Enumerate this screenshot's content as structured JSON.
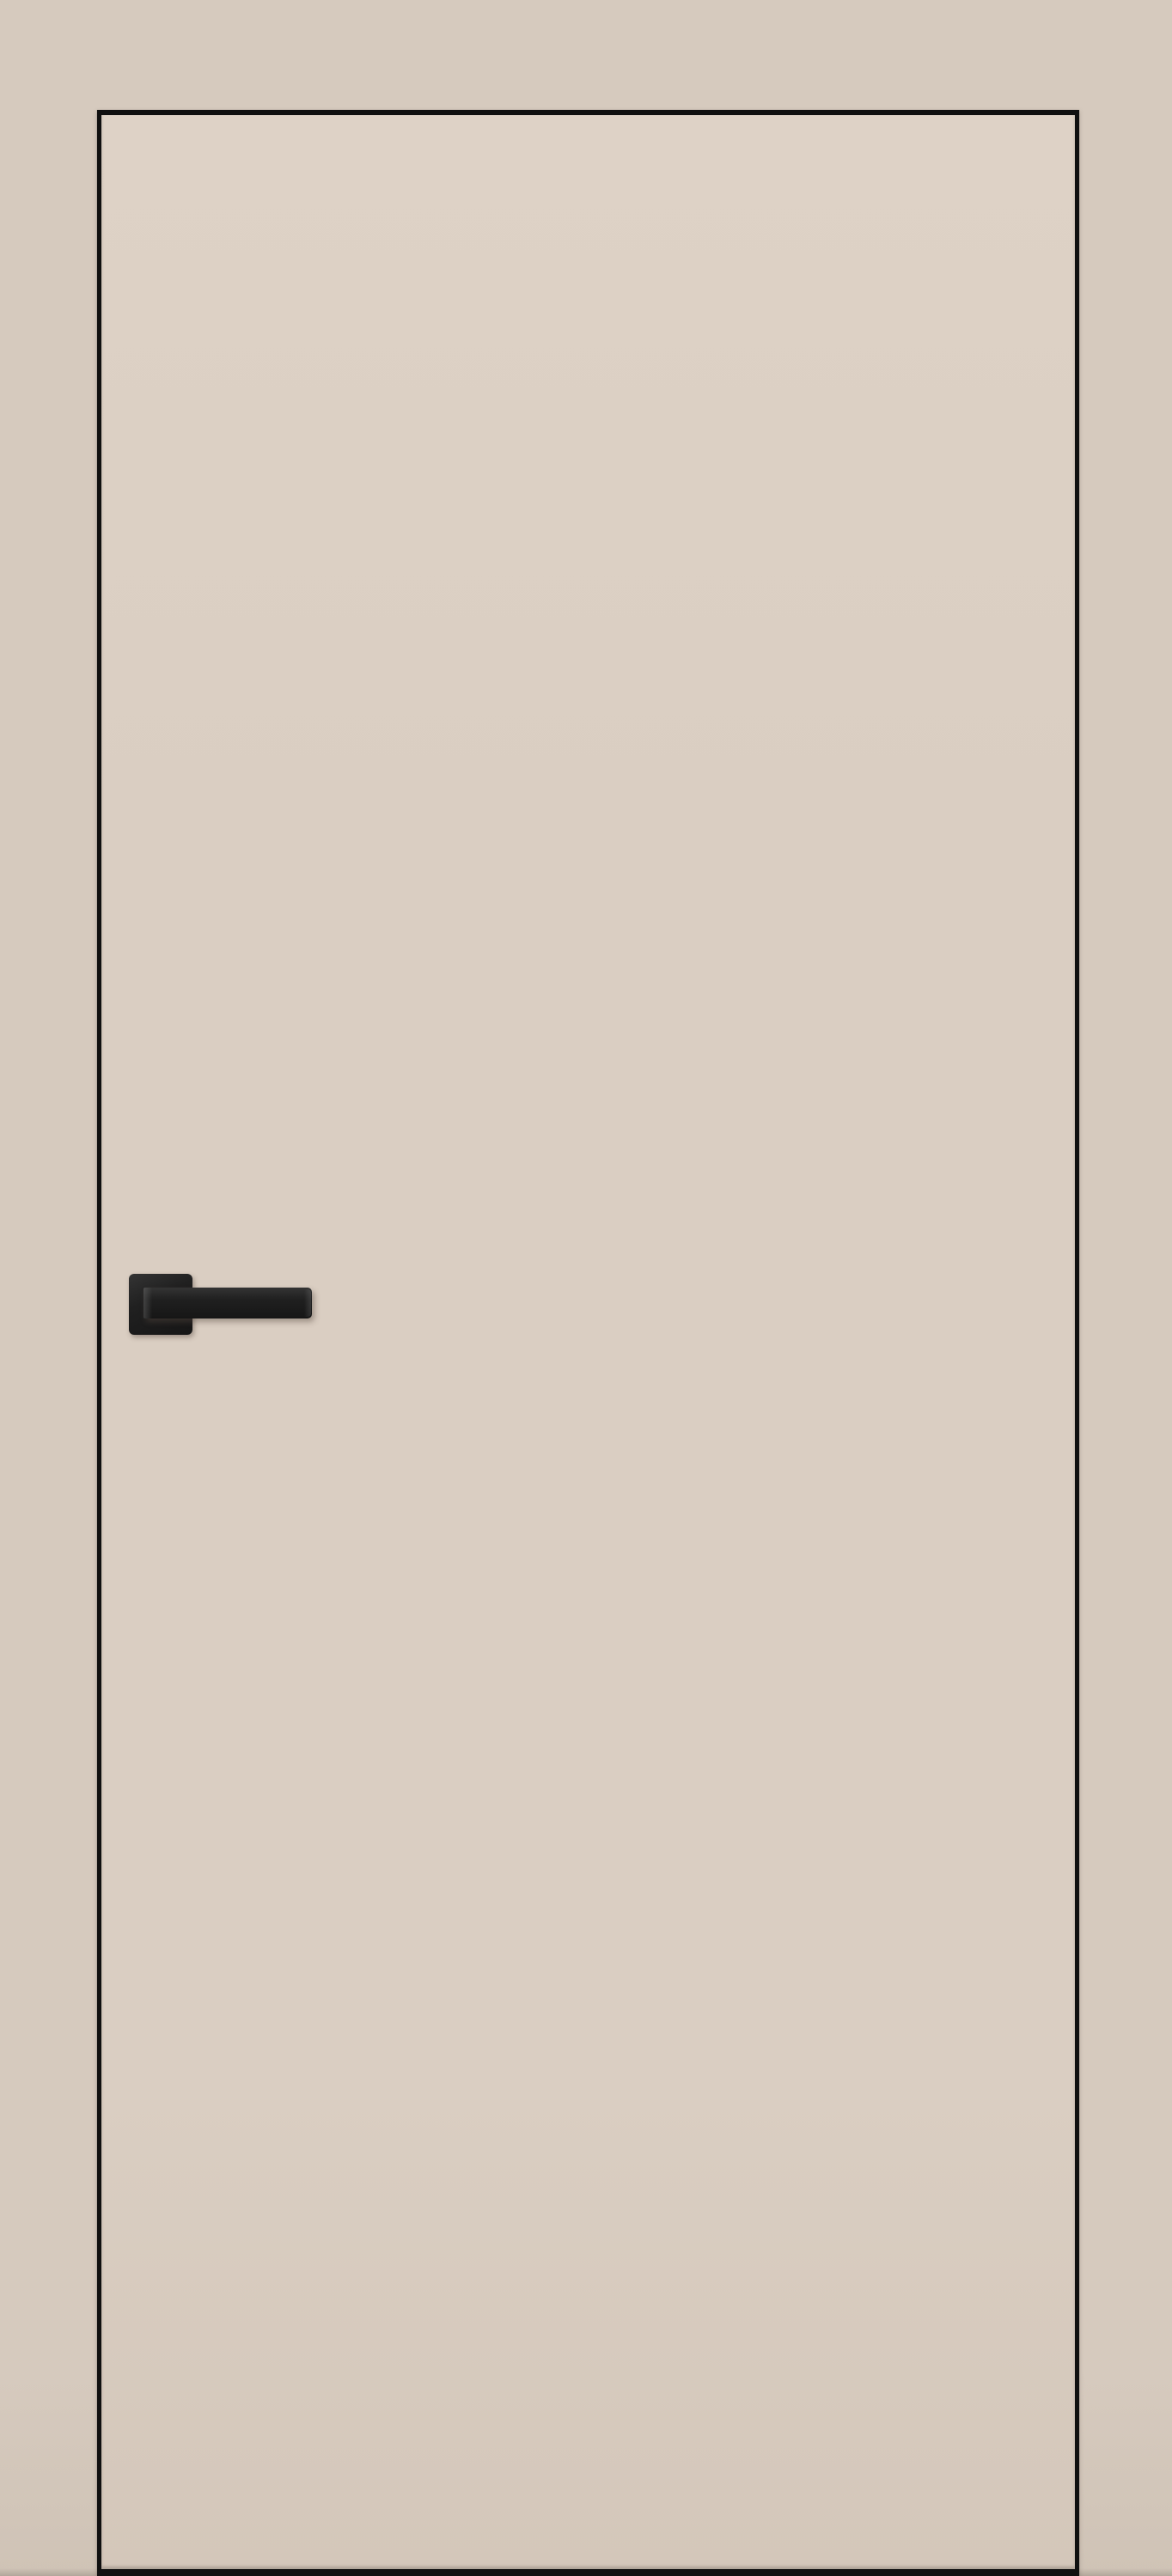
{
  "scene": {
    "subject": "interior flush door with concealed black edge frame",
    "objects": {
      "wall": "wall",
      "door": "door-leaf",
      "door_edge": "black-aluminium-edge",
      "handle": "black-square-rose-lever-handle"
    }
  },
  "colors": {
    "wall": "#d6cabe",
    "wall-bottom": "#cfc3b6",
    "wall-shade": "rgba(110,100,90,0.30)",
    "door": "#dacec2",
    "door-light": "#ded2c6",
    "door-dark": "#d4c7ba",
    "edge": "#101010",
    "handle-dark": "#161616",
    "handle-body": "#202020",
    "handle-highlight": "#343434",
    "handle-shadow": "rgba(86,74,64,0.45)"
  }
}
